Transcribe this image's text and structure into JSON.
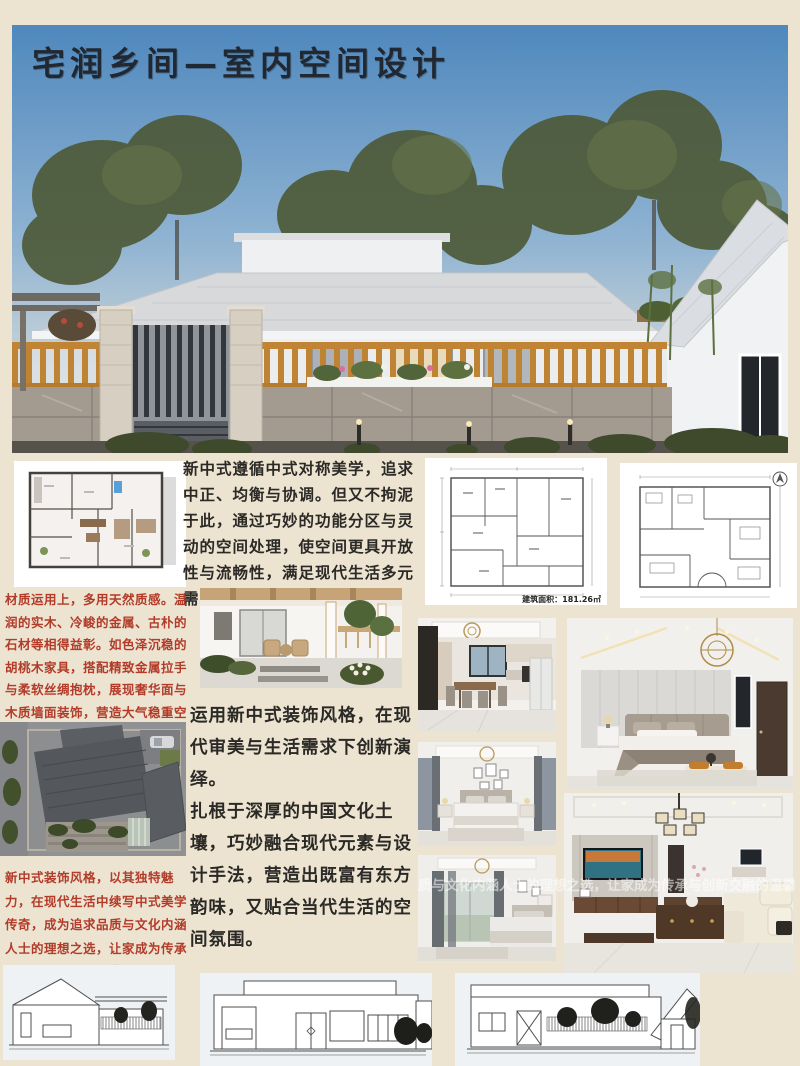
{
  "title": "宅润乡间—室内空间设计",
  "paragraphs": {
    "intro": "新中式遵循中式对称美学，追求中正、均衡与协调。但又不拘泥于此，通过巧妙的功能分区与灵动的空间处理，使空间更具开放性与流畅性，满足现代生活多元需求",
    "materials": "材质运用上，多用天然质感。温润的实木、冷峻的金属、古朴的石材等相得益彰。如色泽沉稳的胡桃木家具，搭配精致金属拉手与柔软丝绸抱枕，展现奢华面与木质墙面装饰，营造大气稳重空间格调",
    "style_line1": "运用新中式装饰风格，在现代审美与生活需求下创新演绎。",
    "style_line2": "扎根于深厚的中国文化土壤，巧妙融合现代元素与设计手法，营造出既富有东方韵味，又贴合当代生活的空间氛围。",
    "closing": "新中式装饰风格，以其独特魅力，在现代生活中续写中式美学传奇，成为追求品质与文化内涵人士的理想之选，让家成为传承与创新交融的温馨港湾。",
    "watermark": "质与文化内涵人士的理想之选，让家成为传承与创新交融的温馨港湾。"
  },
  "plans": {
    "area_label": "建筑面积：181.26㎡"
  },
  "colors": {
    "board_bg": "#ece4d1",
    "sky_blue": "#5c93c4",
    "red_text": "#b23b2a",
    "ink_text": "#2b2926",
    "wood_orange": "#c08434",
    "roof_gray": "#d8d9db"
  }
}
